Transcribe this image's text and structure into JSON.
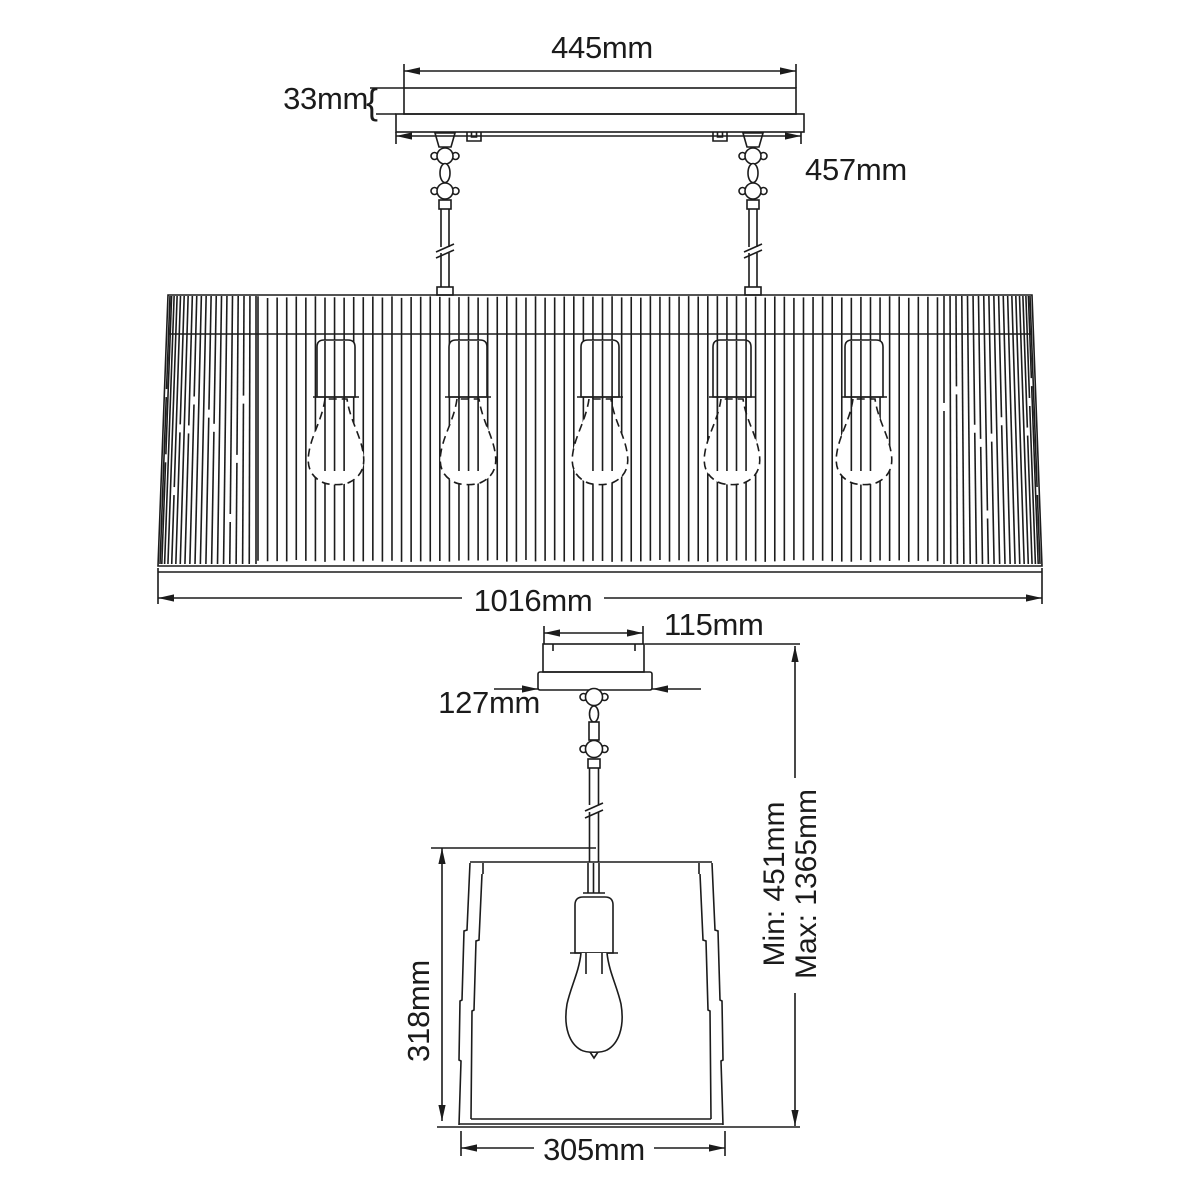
{
  "diagram": {
    "type": "lighting-fixture-dimension-drawing",
    "background_color": "#ffffff",
    "line_color": "#1c1c1c",
    "text_color": "#1b1b1b",
    "upper_fixture": {
      "description": "five-bulb linear drum pendant, front view",
      "bulb_count": 5,
      "dims": {
        "plate_width": "445mm",
        "plate_height": "33mm",
        "plate_height_brace": "{",
        "backplate_width": "457mm",
        "shade_width": "1016mm"
      }
    },
    "lower_fixture": {
      "description": "single-bulb tapered square pendant, front view",
      "bulb_count": 1,
      "dims": {
        "canopy_width": "115mm",
        "canopy_plate_width": "127mm",
        "shade_height": "318mm",
        "shade_width": "305mm",
        "drop_min": "Min: 451mm",
        "drop_max": "Max: 1365mm"
      }
    }
  }
}
